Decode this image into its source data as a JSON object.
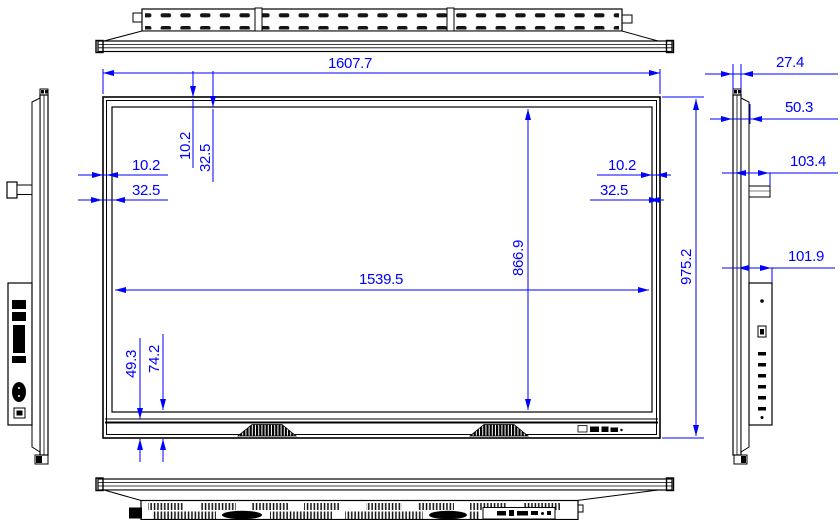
{
  "drawing": {
    "background": "#ffffff",
    "line_color": "#000000",
    "dimension_color": "#0000ff",
    "front": {
      "overall_width": "1607.7",
      "overall_height": "975.2",
      "active_width": "1539.5",
      "active_height": "866.9",
      "top_offset_inner": "10.2",
      "top_offset_outer": "32.5",
      "left_offset_inner": "10.2",
      "left_offset_outer": "32.5",
      "right_offset_inner": "10.2",
      "right_offset_outer": "32.5",
      "bottom_offset_inner": "49.3",
      "bottom_offset_outer": "74.2"
    },
    "side": {
      "panel_thickness": "27.4",
      "body_depth": "50.3",
      "bracket_depth": "103.4",
      "box_depth": "101.9"
    }
  }
}
